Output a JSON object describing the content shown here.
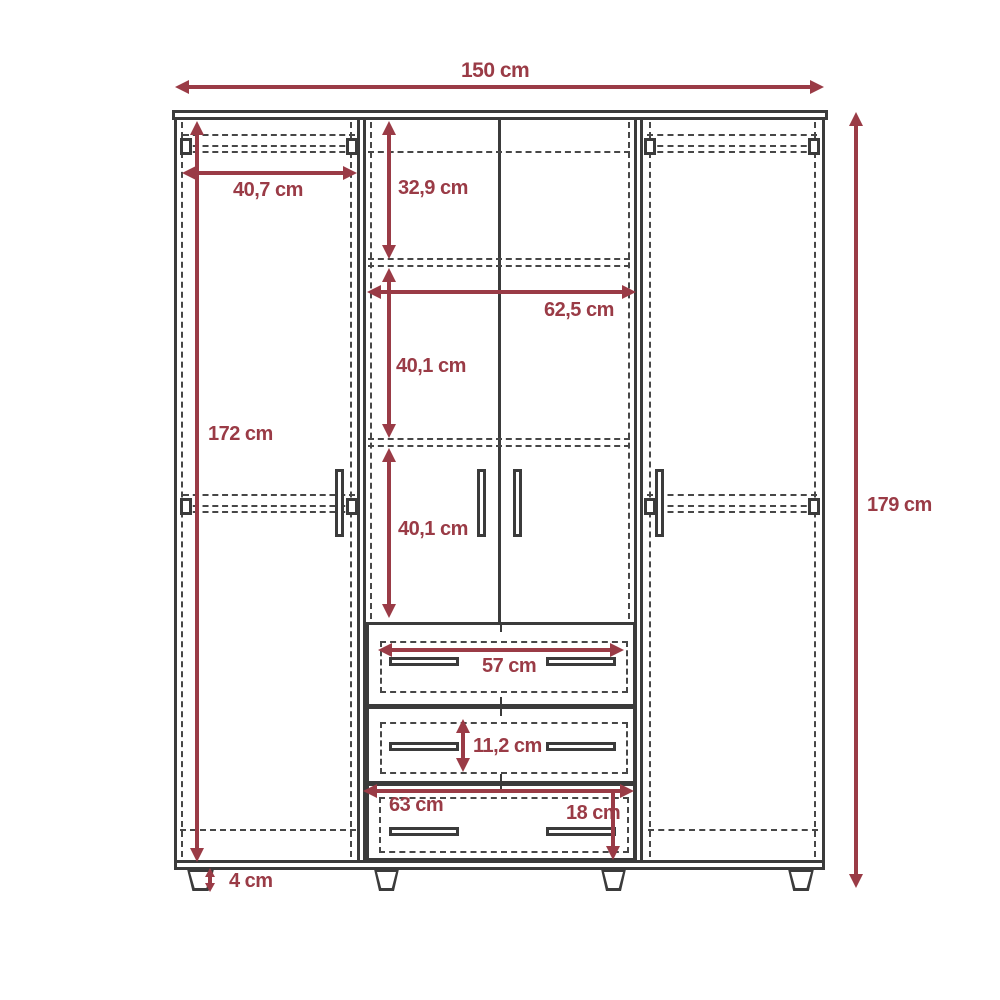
{
  "unit": "cm",
  "colors": {
    "accent": "#9a3b46",
    "line": "#3b3b3b",
    "background": "#ffffff"
  },
  "dims": {
    "total_width": "150 cm",
    "total_height": "179 cm",
    "left_interior_height": "172 cm",
    "left_door_width": "40,7 cm",
    "top_section_height": "32,9 cm",
    "middle_section_width": "62,5 cm",
    "upper_middle_section_height": "40,1 cm",
    "lower_middle_section_height": "40,1 cm",
    "top_drawer_width": "57 cm",
    "middle_drawer_height": "11,2 cm",
    "bottom_drawer_width": "63 cm",
    "bottom_drawer_height": "18 cm",
    "leg_height": "4 cm"
  }
}
